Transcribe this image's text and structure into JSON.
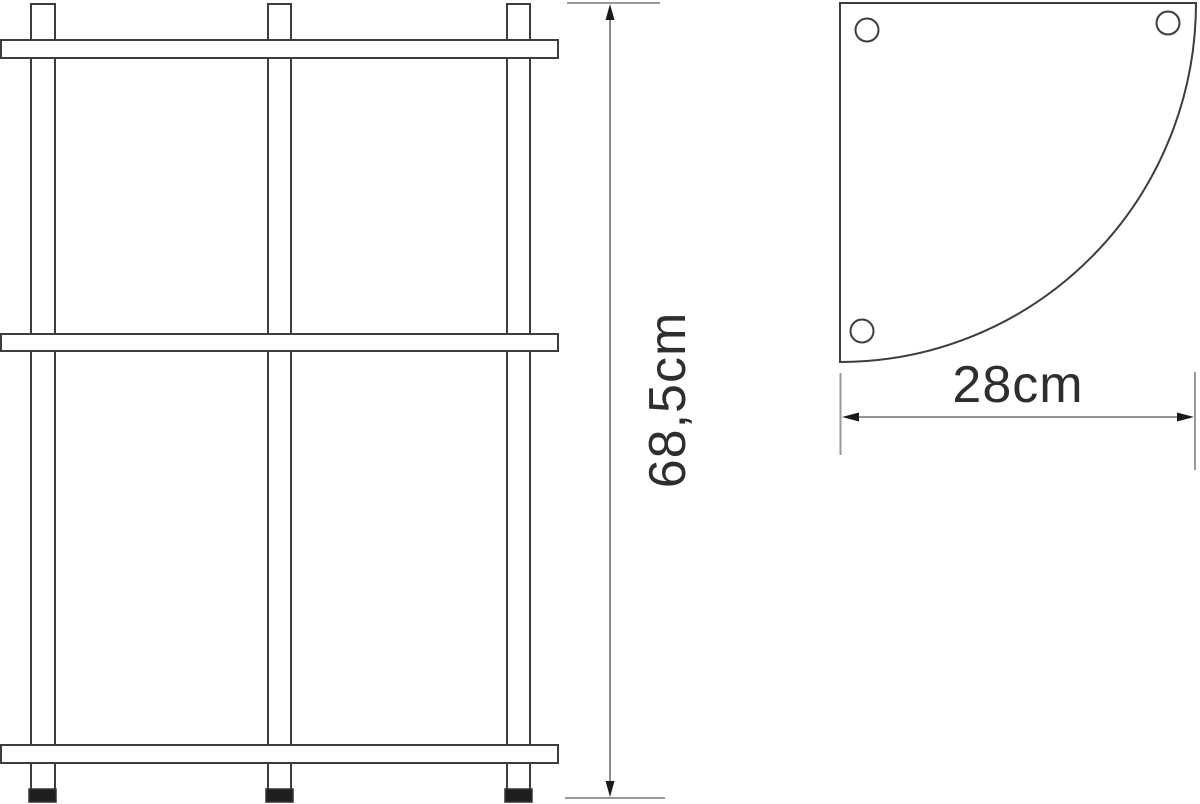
{
  "diagram": {
    "type": "product-dimension-drawing",
    "product": "three-tier corner shelf",
    "views": {
      "front_elevation": {
        "shelf_count": 3,
        "post_count": 3,
        "foot_count": 3
      },
      "top_plan": {
        "shape": "quarter-circle",
        "hole_count": 3
      }
    },
    "dimensions": {
      "height": {
        "value": "68,5cm",
        "orientation": "vertical"
      },
      "width": {
        "value": "28cm",
        "orientation": "horizontal"
      }
    },
    "colors": {
      "background": "#ffffff",
      "line": "#3d3d3d",
      "dimension_line": "#707070",
      "tick": "#9a9a9a",
      "arrowhead": "#1a1a1a",
      "foot_fill": "#1f1f1f",
      "text": "#2e2e2e"
    }
  }
}
